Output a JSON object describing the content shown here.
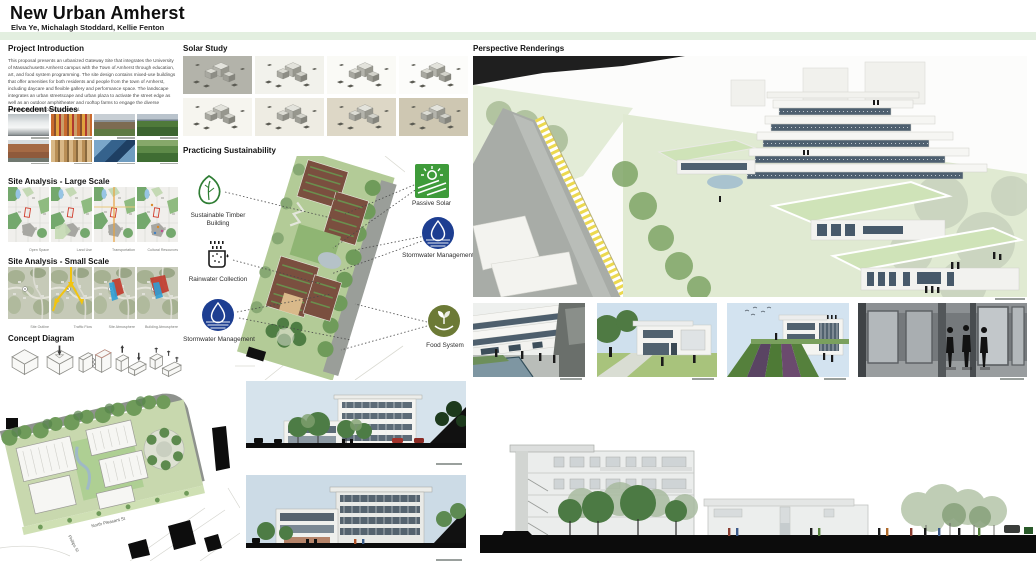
{
  "header": {
    "title": "New Urban Amherst",
    "authors": "Elva Ye, Michalagh Stoddard, Kellie Fenton"
  },
  "headings": {
    "project_introduction": "Project Introduction",
    "precedent_studies": "Precedent Studies",
    "site_analysis_large": "Site Analysis - Large Scale",
    "site_analysis_small": "Site Analysis - Small Scale",
    "concept_diagram": "Concept Diagram",
    "solar_study": "Solar Study",
    "practicing_sustainability": "Practicing Sustainability",
    "perspective_renderings": "Perspective Renderings"
  },
  "project_introduction": {
    "body": "This proposal presents an urbanized Gateway Site that integrates the University of Massachusetts Amherst campus with the Town of Amherst through education, art, and food system programming.  The site design contains mixed-use buildings that offer amenities for both residents and people from the town of Amherst, including daycare and flexible gallery and performance space.  The landscape integrates an urban streetscape and urban plaza to activate the street edge as well as an outdoor amphitheater and rooftop farms to engage the diverse community of the town and school."
  },
  "site_analysis_large": {
    "captions": [
      "Open Space",
      "Land Use",
      "Transportation",
      "Cultural Resources"
    ]
  },
  "site_analysis_small": {
    "captions": [
      "Site Outline",
      "Traffic Flow",
      "Site Atmosphere",
      "Building Atmosphere"
    ]
  },
  "sustainability": {
    "labels": {
      "timber": "Sustainable Timber Building",
      "rainwater": "Rainwater Collection",
      "stormwater_left": "Stormwater Management",
      "passive_solar": "Passive Solar",
      "stormwater_right": "Stormwater Management",
      "food_system": "Food System"
    }
  },
  "site_plan": {
    "street_main": "North Pleasant St",
    "street_side": "Phillips St"
  },
  "colors": {
    "accent_bar": "#e3efe0",
    "stormwater_blue": "#1d3e91",
    "passive_solar_green": "#3e9b3a",
    "food_olive": "#6c7a36",
    "leaf_green": "#2e7d33",
    "fence_yellow": "#ecd94f"
  }
}
